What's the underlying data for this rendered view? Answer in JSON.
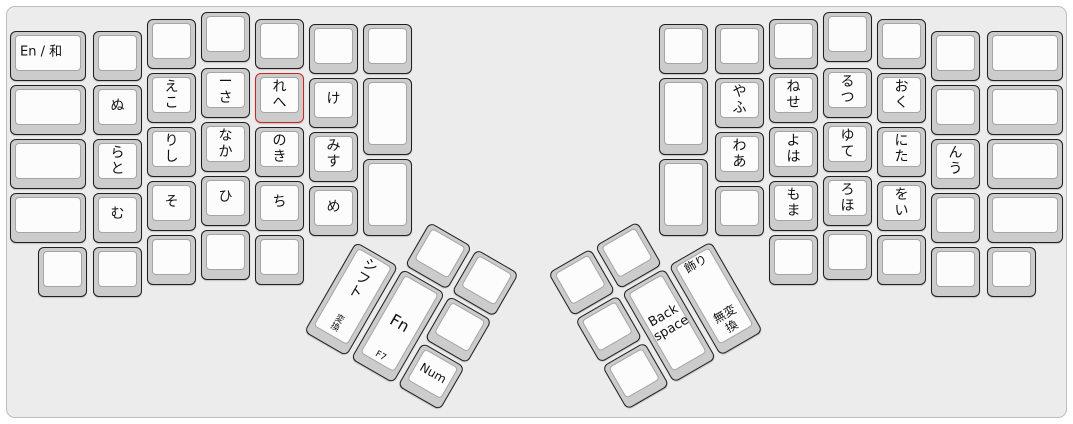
{
  "colors": {
    "page_bg": "#ffffff",
    "board_bg": "#ececec",
    "board_border": "#bdbdbd",
    "key_base": "#cccccc",
    "key_border": "#1f1f1f",
    "cap_bg": "#fcfcfc",
    "cap_border": "#a5a5a5",
    "label": "#111111",
    "highlight_border": "#cc2222"
  },
  "groups": {
    "left_main": {
      "name": "left-hand-block",
      "origin": [
        0,
        0
      ],
      "rotation": 0,
      "keys": [
        {
          "name": "en-ja-toggle-key",
          "x": 10,
          "y": 31,
          "w": 76,
          "h": 50,
          "labels": [
            {
              "text": "En / 和",
              "pos": "left",
              "size": 13
            }
          ]
        },
        {
          "name": "blank-key",
          "x": 10,
          "y": 85,
          "w": 76,
          "h": 50,
          "labels": []
        },
        {
          "name": "blank-key",
          "x": 10,
          "y": 139,
          "w": 76,
          "h": 50,
          "labels": []
        },
        {
          "name": "blank-key",
          "x": 10,
          "y": 193,
          "w": 76,
          "h": 50,
          "labels": []
        },
        {
          "name": "blank-key",
          "x": 38,
          "y": 247,
          "w": 49,
          "h": 50,
          "labels": []
        },
        {
          "name": "blank-key",
          "x": 93,
          "y": 31,
          "w": 49,
          "h": 50,
          "labels": []
        },
        {
          "name": "kana-key",
          "x": 93,
          "y": 85,
          "w": 49,
          "h": 50,
          "labels": [
            {
              "text": "ぬ",
              "pos": "mid",
              "size": 14
            }
          ]
        },
        {
          "name": "kana-key",
          "x": 93,
          "y": 139,
          "w": 49,
          "h": 50,
          "labels": [
            {
              "text": "ら",
              "pos": "top",
              "size": 14
            },
            {
              "text": "と",
              "pos": "bot",
              "size": 14
            }
          ]
        },
        {
          "name": "kana-key",
          "x": 93,
          "y": 193,
          "w": 49,
          "h": 50,
          "labels": [
            {
              "text": "む",
              "pos": "mid",
              "size": 14
            }
          ]
        },
        {
          "name": "blank-key",
          "x": 93,
          "y": 247,
          "w": 49,
          "h": 50,
          "labels": []
        },
        {
          "name": "blank-key",
          "x": 147,
          "y": 19,
          "w": 49,
          "h": 50,
          "labels": []
        },
        {
          "name": "kana-key",
          "x": 147,
          "y": 73,
          "w": 49,
          "h": 50,
          "labels": [
            {
              "text": "え",
              "pos": "top",
              "size": 14
            },
            {
              "text": "こ",
              "pos": "bot",
              "size": 14
            }
          ]
        },
        {
          "name": "kana-key",
          "x": 147,
          "y": 127,
          "w": 49,
          "h": 50,
          "labels": [
            {
              "text": "り",
              "pos": "top",
              "size": 14
            },
            {
              "text": "し",
              "pos": "bot",
              "size": 14
            }
          ]
        },
        {
          "name": "kana-key",
          "x": 147,
          "y": 181,
          "w": 49,
          "h": 50,
          "labels": [
            {
              "text": "そ",
              "pos": "mid",
              "size": 14
            }
          ]
        },
        {
          "name": "blank-key",
          "x": 147,
          "y": 235,
          "w": 49,
          "h": 50,
          "labels": []
        },
        {
          "name": "blank-key",
          "x": 201,
          "y": 12,
          "w": 49,
          "h": 50,
          "labels": []
        },
        {
          "name": "kana-key",
          "x": 201,
          "y": 68,
          "w": 49,
          "h": 50,
          "labels": [
            {
              "text": "ー",
              "pos": "top",
              "size": 14
            },
            {
              "text": "さ",
              "pos": "bot",
              "size": 14
            }
          ]
        },
        {
          "name": "kana-key",
          "x": 201,
          "y": 122,
          "w": 49,
          "h": 50,
          "labels": [
            {
              "text": "な",
              "pos": "top",
              "size": 14
            },
            {
              "text": "か",
              "pos": "bot",
              "size": 14
            }
          ]
        },
        {
          "name": "kana-key",
          "x": 201,
          "y": 176,
          "w": 49,
          "h": 50,
          "labels": [
            {
              "text": "ひ",
              "pos": "mid",
              "size": 14
            }
          ]
        },
        {
          "name": "blank-key",
          "x": 201,
          "y": 230,
          "w": 49,
          "h": 50,
          "labels": []
        },
        {
          "name": "blank-key",
          "x": 255,
          "y": 19,
          "w": 49,
          "h": 50,
          "labels": []
        },
        {
          "name": "kana-key-highlighted",
          "x": 255,
          "y": 73,
          "w": 49,
          "h": 50,
          "highlight": true,
          "labels": [
            {
              "text": "れ",
              "pos": "top",
              "size": 14
            },
            {
              "text": "へ",
              "pos": "bot",
              "size": 14
            }
          ]
        },
        {
          "name": "kana-key",
          "x": 255,
          "y": 127,
          "w": 49,
          "h": 50,
          "labels": [
            {
              "text": "の",
              "pos": "top",
              "size": 14
            },
            {
              "text": "き",
              "pos": "bot",
              "size": 14
            }
          ]
        },
        {
          "name": "kana-key",
          "x": 255,
          "y": 181,
          "w": 49,
          "h": 50,
          "labels": [
            {
              "text": "ち",
              "pos": "mid",
              "size": 14
            }
          ]
        },
        {
          "name": "blank-key",
          "x": 255,
          "y": 235,
          "w": 49,
          "h": 50,
          "labels": []
        },
        {
          "name": "blank-key",
          "x": 309,
          "y": 24,
          "w": 49,
          "h": 50,
          "labels": []
        },
        {
          "name": "kana-key",
          "x": 309,
          "y": 78,
          "w": 49,
          "h": 50,
          "labels": [
            {
              "text": "け",
              "pos": "mid",
              "size": 14
            }
          ]
        },
        {
          "name": "kana-key",
          "x": 309,
          "y": 132,
          "w": 49,
          "h": 50,
          "labels": [
            {
              "text": "み",
              "pos": "top",
              "size": 14
            },
            {
              "text": "す",
              "pos": "bot",
              "size": 14
            }
          ]
        },
        {
          "name": "kana-key",
          "x": 309,
          "y": 186,
          "w": 49,
          "h": 50,
          "labels": [
            {
              "text": "め",
              "pos": "mid",
              "size": 14
            }
          ]
        },
        {
          "name": "blank-key",
          "x": 363,
          "y": 24,
          "w": 49,
          "h": 50,
          "labels": []
        },
        {
          "name": "blank-key",
          "x": 363,
          "y": 78,
          "w": 49,
          "h": 77,
          "labels": []
        },
        {
          "name": "blank-key",
          "x": 363,
          "y": 159,
          "w": 49,
          "h": 77,
          "labels": []
        }
      ]
    },
    "right_main": {
      "name": "right-hand-block",
      "origin": [
        0,
        0
      ],
      "rotation": 0,
      "keys": [
        {
          "name": "blank-key",
          "x": 659,
          "y": 24,
          "w": 49,
          "h": 50,
          "labels": []
        },
        {
          "name": "blank-key",
          "x": 659,
          "y": 78,
          "w": 49,
          "h": 77,
          "labels": []
        },
        {
          "name": "blank-key",
          "x": 659,
          "y": 159,
          "w": 49,
          "h": 77,
          "labels": []
        },
        {
          "name": "blank-key",
          "x": 715,
          "y": 24,
          "w": 49,
          "h": 50,
          "labels": []
        },
        {
          "name": "kana-key",
          "x": 715,
          "y": 78,
          "w": 49,
          "h": 50,
          "labels": [
            {
              "text": "や",
              "pos": "top",
              "size": 14
            },
            {
              "text": "ふ",
              "pos": "bot",
              "size": 14
            }
          ]
        },
        {
          "name": "kana-key",
          "x": 715,
          "y": 132,
          "w": 49,
          "h": 50,
          "labels": [
            {
              "text": "わ",
              "pos": "top",
              "size": 14
            },
            {
              "text": "あ",
              "pos": "bot",
              "size": 14
            }
          ]
        },
        {
          "name": "blank-key",
          "x": 715,
          "y": 186,
          "w": 49,
          "h": 50,
          "labels": []
        },
        {
          "name": "blank-key",
          "x": 769,
          "y": 19,
          "w": 49,
          "h": 50,
          "labels": []
        },
        {
          "name": "kana-key",
          "x": 769,
          "y": 73,
          "w": 49,
          "h": 50,
          "labels": [
            {
              "text": "ね",
              "pos": "top",
              "size": 14
            },
            {
              "text": "せ",
              "pos": "bot",
              "size": 14
            }
          ]
        },
        {
          "name": "kana-key",
          "x": 769,
          "y": 127,
          "w": 49,
          "h": 50,
          "labels": [
            {
              "text": "よ",
              "pos": "top",
              "size": 14
            },
            {
              "text": "は",
              "pos": "bot",
              "size": 14
            }
          ]
        },
        {
          "name": "kana-key",
          "x": 769,
          "y": 181,
          "w": 49,
          "h": 50,
          "labels": [
            {
              "text": "も",
              "pos": "top",
              "size": 14
            },
            {
              "text": "ま",
              "pos": "bot",
              "size": 14
            }
          ]
        },
        {
          "name": "blank-key",
          "x": 769,
          "y": 235,
          "w": 49,
          "h": 50,
          "labels": []
        },
        {
          "name": "blank-key",
          "x": 823,
          "y": 12,
          "w": 49,
          "h": 50,
          "labels": []
        },
        {
          "name": "kana-key",
          "x": 823,
          "y": 68,
          "w": 49,
          "h": 50,
          "labels": [
            {
              "text": "る",
              "pos": "top",
              "size": 14
            },
            {
              "text": "つ",
              "pos": "bot",
              "size": 14
            }
          ]
        },
        {
          "name": "kana-key",
          "x": 823,
          "y": 122,
          "w": 49,
          "h": 50,
          "labels": [
            {
              "text": "ゆ",
              "pos": "top",
              "size": 14
            },
            {
              "text": "て",
              "pos": "bot",
              "size": 14
            }
          ]
        },
        {
          "name": "kana-key",
          "x": 823,
          "y": 176,
          "w": 49,
          "h": 50,
          "labels": [
            {
              "text": "ろ",
              "pos": "top",
              "size": 14
            },
            {
              "text": "ほ",
              "pos": "bot",
              "size": 14
            }
          ]
        },
        {
          "name": "blank-key",
          "x": 823,
          "y": 230,
          "w": 49,
          "h": 50,
          "labels": []
        },
        {
          "name": "blank-key",
          "x": 877,
          "y": 19,
          "w": 49,
          "h": 50,
          "labels": []
        },
        {
          "name": "kana-key",
          "x": 877,
          "y": 73,
          "w": 49,
          "h": 50,
          "labels": [
            {
              "text": "お",
              "pos": "top",
              "size": 14
            },
            {
              "text": "く",
              "pos": "bot",
              "size": 14
            }
          ]
        },
        {
          "name": "kana-key",
          "x": 877,
          "y": 127,
          "w": 49,
          "h": 50,
          "labels": [
            {
              "text": "に",
              "pos": "top",
              "size": 14
            },
            {
              "text": "た",
              "pos": "bot",
              "size": 14
            }
          ]
        },
        {
          "name": "kana-key",
          "x": 877,
          "y": 181,
          "w": 49,
          "h": 50,
          "labels": [
            {
              "text": "を",
              "pos": "top",
              "size": 14
            },
            {
              "text": "い",
              "pos": "bot",
              "size": 14
            }
          ]
        },
        {
          "name": "blank-key",
          "x": 877,
          "y": 235,
          "w": 49,
          "h": 50,
          "labels": []
        },
        {
          "name": "blank-key",
          "x": 931,
          "y": 31,
          "w": 49,
          "h": 50,
          "labels": []
        },
        {
          "name": "blank-key",
          "x": 931,
          "y": 85,
          "w": 49,
          "h": 50,
          "labels": []
        },
        {
          "name": "kana-key",
          "x": 931,
          "y": 139,
          "w": 49,
          "h": 50,
          "labels": [
            {
              "text": "ん",
              "pos": "top",
              "size": 14
            },
            {
              "text": "う",
              "pos": "bot",
              "size": 14
            }
          ]
        },
        {
          "name": "blank-key",
          "x": 931,
          "y": 193,
          "w": 49,
          "h": 50,
          "labels": []
        },
        {
          "name": "blank-key",
          "x": 931,
          "y": 247,
          "w": 49,
          "h": 50,
          "labels": []
        },
        {
          "name": "blank-key",
          "x": 987,
          "y": 31,
          "w": 76,
          "h": 50,
          "labels": []
        },
        {
          "name": "blank-key",
          "x": 987,
          "y": 85,
          "w": 76,
          "h": 50,
          "labels": []
        },
        {
          "name": "blank-key",
          "x": 987,
          "y": 139,
          "w": 76,
          "h": 50,
          "labels": []
        },
        {
          "name": "blank-key",
          "x": 987,
          "y": 193,
          "w": 76,
          "h": 50,
          "labels": []
        },
        {
          "name": "blank-key",
          "x": 987,
          "y": 247,
          "w": 49,
          "h": 50,
          "labels": []
        }
      ]
    },
    "left_thumb": {
      "name": "left-thumb-cluster",
      "origin": [
        383,
        195
      ],
      "rotation": 30,
      "keys": [
        {
          "name": "blank-key",
          "x": 54,
          "y": 0,
          "w": 49,
          "h": 50,
          "labels": []
        },
        {
          "name": "blank-key",
          "x": 108,
          "y": 0,
          "w": 49,
          "h": 50,
          "labels": []
        },
        {
          "name": "shift-key",
          "x": 0,
          "y": 54,
          "w": 49,
          "h": 104,
          "labels": [
            {
              "text": "シフト",
              "pos": "top",
              "size": 14,
              "vert": true
            },
            {
              "text": "変換",
              "pos": "bot",
              "size": 9,
              "vert": true
            }
          ]
        },
        {
          "name": "fn-key",
          "x": 54,
          "y": 54,
          "w": 49,
          "h": 104,
          "labels": [
            {
              "text": "Fn",
              "pos": "mid",
              "size": 16
            },
            {
              "text": "F7",
              "pos": "bot",
              "size": 9
            }
          ]
        },
        {
          "name": "blank-key",
          "x": 108,
          "y": 54,
          "w": 49,
          "h": 50,
          "labels": []
        },
        {
          "name": "num-key",
          "x": 108,
          "y": 108,
          "w": 49,
          "h": 50,
          "labels": [
            {
              "text": "Num",
              "pos": "mid",
              "size": 12
            }
          ]
        }
      ]
    },
    "right_thumb": {
      "name": "right-thumb-cluster",
      "origin": [
        548,
        273
      ],
      "rotation": -30,
      "keys": [
        {
          "name": "blank-key",
          "x": 0,
          "y": 0,
          "w": 49,
          "h": 50,
          "labels": []
        },
        {
          "name": "blank-key",
          "x": 54,
          "y": 0,
          "w": 49,
          "h": 50,
          "labels": []
        },
        {
          "name": "blank-key",
          "x": 0,
          "y": 54,
          "w": 49,
          "h": 50,
          "labels": []
        },
        {
          "name": "backspace-key",
          "x": 54,
          "y": 54,
          "w": 49,
          "h": 104,
          "labels": [
            {
              "text": "Back space",
              "pos": "mid",
              "size": 13
            }
          ]
        },
        {
          "name": "kazari-muhenkan-key",
          "x": 108,
          "y": 54,
          "w": 49,
          "h": 104,
          "labels": [
            {
              "text": "飾り",
              "pos": "top",
              "size": 12
            },
            {
              "text": "無変換",
              "pos": "bot",
              "size": 12
            }
          ]
        },
        {
          "name": "blank-key",
          "x": 0,
          "y": 108,
          "w": 49,
          "h": 50,
          "labels": []
        }
      ]
    }
  }
}
